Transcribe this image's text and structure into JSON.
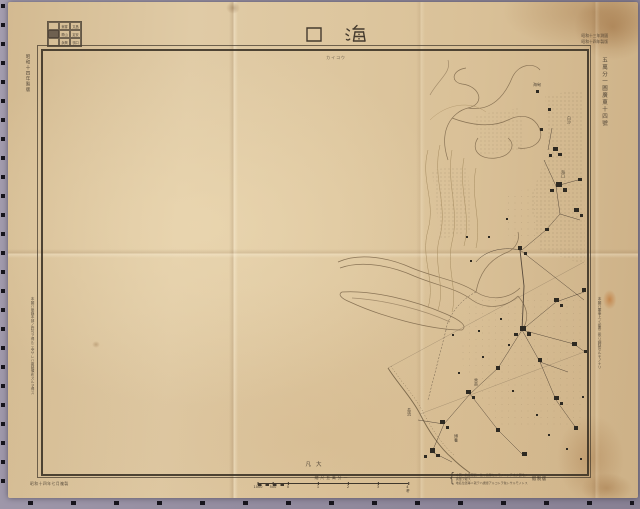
{
  "document": {
    "type": "scanned military topographic map sheet",
    "sheet_title": "海口"
  },
  "header": {
    "title": "海口",
    "title_display": "口　海",
    "subtitle_kana": "カイコウ",
    "top_right_note_line1": "昭和十三年測圖",
    "top_right_note_line2": "昭和十四年製版"
  },
  "index_grid": {
    "name": "隣接圖表",
    "rows": [
      [
        "",
        "東寨",
        "文昌"
      ],
      [
        "",
        "瓊山",
        "定安"
      ],
      [
        "",
        "永興",
        "嶺口"
      ]
    ],
    "current_cell": {
      "row": 1,
      "col": 0
    }
  },
  "margins": {
    "left_top_vertical": "昭和十四年製版",
    "left_long_vertical": "本圖ハ參謀本部ノ許可ヲ得ルニ非サレハ複製頒布スルヲ得ス",
    "right_series_vertical": "五萬分一圖廣東十四號",
    "right_long_vertical": "本圖ハ軍事上ノ必要ニ依リ調製セルモノナリ",
    "bottom_left_note": "昭和十四年七月複製",
    "bottom_right_brace": "{",
    "bottom_right_note_line1": "本圖ハ航空寫眞ニ依リ編纂セルモノニシテ未タ實地ノ測量ヲ經ス",
    "bottom_right_note_line2": "地名位置等ニ就テハ誤謬アルコトヲ免レサルモノトス",
    "bottom_right_label": "假製版"
  },
  "footer": {
    "inner_label": "凡大",
    "scale_label": "縮尺五萬分一",
    "scale_ticks": [
      {
        "label": "1000",
        "pct": 0
      },
      {
        "label": "500",
        "pct": 10
      },
      {
        "label": "0",
        "pct": 20
      },
      {
        "label": "1",
        "pct": 40
      },
      {
        "label": "2",
        "pct": 60
      },
      {
        "label": "3",
        "pct": 80
      },
      {
        "label": "4粁",
        "pct": 100
      }
    ]
  },
  "map_labels": [
    {
      "text": "海甸",
      "x": 533,
      "y": 82,
      "vertical": false
    },
    {
      "text": "白沙",
      "x": 566,
      "y": 116,
      "vertical": true
    },
    {
      "text": "海口",
      "x": 560,
      "y": 170,
      "vertical": true
    },
    {
      "text": "秀英",
      "x": 473,
      "y": 378,
      "vertical": true
    },
    {
      "text": "長流",
      "x": 406,
      "y": 408,
      "vertical": true
    },
    {
      "text": "博養",
      "x": 453,
      "y": 434,
      "vertical": true
    }
  ],
  "colors": {
    "paper": "#dcc49c",
    "ink": "#3a3127",
    "line_sepia": "#8a7456",
    "backdrop": "#988fa3",
    "registration_mark": "#17151c"
  }
}
